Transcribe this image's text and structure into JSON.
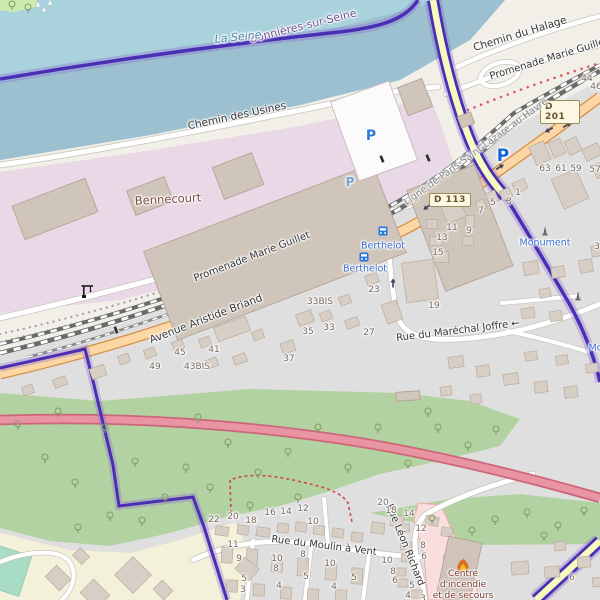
{
  "shields": {
    "d113": {
      "label": "D 113",
      "x": 450,
      "y": 200
    },
    "d201": {
      "label": "D 201",
      "x": 560,
      "y": 112
    }
  },
  "labels": {
    "roads": [
      {
        "text": "Chemin des Usines",
        "x": 237,
        "y": 116,
        "rot": -12,
        "size": 10.5
      },
      {
        "text": "Chemin du Halage",
        "x": 520,
        "y": 34,
        "rot": -17,
        "size": 10.5
      },
      {
        "text": "Promenade Marie Guillet",
        "x": 549,
        "y": 59,
        "rot": -17,
        "size": 10
      },
      {
        "text": "Promenade Marie Guillet",
        "x": 252,
        "y": 257,
        "rot": -21,
        "size": 10
      },
      {
        "text": "Avenue Aristide Briand",
        "x": 206,
        "y": 319,
        "rot": -21,
        "size": 10.5
      },
      {
        "text": "Rue du Maréchal Joffre ←",
        "x": 458,
        "y": 331,
        "rot": -7,
        "size": 10
      },
      {
        "text": "Rue du Moulin à Vent",
        "x": 324,
        "y": 546,
        "rot": 7,
        "size": 10
      },
      {
        "text": "Rue Léon Richard",
        "x": 405,
        "y": 545,
        "rot": 68,
        "size": 10
      }
    ],
    "railway": [
      {
        "text": "Ligne de Paris-Saint-Lazare au Havre",
        "x": 476,
        "y": 152,
        "rot": -36,
        "size": 9.5
      }
    ],
    "places": [
      {
        "text": "Bennecourt",
        "x": 168,
        "y": 199,
        "rot": -3,
        "size": 11.5,
        "color": "#7a4b45"
      },
      {
        "text": "Bonnières-sur-Seine",
        "x": 303,
        "y": 26,
        "rot": -14,
        "size": 11,
        "color": "#6d5490"
      },
      {
        "text": "La Seine",
        "x": 238,
        "y": 37,
        "rot": -6,
        "size": 11,
        "color": "#4d7fa8",
        "italic": true
      }
    ],
    "pois": [
      {
        "text": "Berthelot",
        "x": 383,
        "y": 246,
        "size": 9.5
      },
      {
        "text": "Berthelot",
        "x": 365,
        "y": 269,
        "size": 9.5
      },
      {
        "text": "Monument",
        "x": 545,
        "y": 243,
        "size": 9.5
      },
      {
        "text": "Monument",
        "x": 614,
        "y": 348,
        "size": 9.5
      }
    ],
    "fire_station": [
      {
        "text": "Centre",
        "x": 463,
        "y": 574,
        "size": 9
      },
      {
        "text": "d'incendie",
        "x": 463,
        "y": 585,
        "size": 9
      },
      {
        "text": "et de secours",
        "x": 463,
        "y": 596,
        "size": 9
      }
    ],
    "parkings": [
      {
        "text": "P",
        "x": 371,
        "y": 136,
        "size": 14,
        "color": "#2e7cd6",
        "op": 1
      },
      {
        "text": "P",
        "x": 350,
        "y": 182,
        "size": 12,
        "color": "#5f9bd8",
        "op": 0.8
      },
      {
        "text": "P",
        "x": 503,
        "y": 156,
        "size": 17,
        "color": "#1565d8",
        "op": 1
      }
    ],
    "housenumbers": [
      {
        "text": "44",
        "x": 587,
        "y": 79
      },
      {
        "text": "46",
        "x": 596,
        "y": 87
      },
      {
        "text": "63",
        "x": 545,
        "y": 169
      },
      {
        "text": "61",
        "x": 561,
        "y": 169
      },
      {
        "text": "59",
        "x": 576,
        "y": 169
      },
      {
        "text": "57",
        "x": 595,
        "y": 170
      },
      {
        "text": "1",
        "x": 518,
        "y": 193
      },
      {
        "text": "3",
        "x": 509,
        "y": 202
      },
      {
        "text": "5",
        "x": 493,
        "y": 203
      },
      {
        "text": "7",
        "x": 481,
        "y": 211
      },
      {
        "text": "11",
        "x": 452,
        "y": 228
      },
      {
        "text": "9",
        "x": 469,
        "y": 231
      },
      {
        "text": "13",
        "x": 442,
        "y": 238
      },
      {
        "text": "15",
        "x": 438,
        "y": 253
      },
      {
        "text": "19",
        "x": 434,
        "y": 306
      },
      {
        "text": "3",
        "x": 597,
        "y": 247
      },
      {
        "text": "23",
        "x": 374,
        "y": 290
      },
      {
        "text": "33BIS",
        "x": 320,
        "y": 302
      },
      {
        "text": "33",
        "x": 329,
        "y": 328
      },
      {
        "text": "35",
        "x": 308,
        "y": 332
      },
      {
        "text": "27",
        "x": 369,
        "y": 333
      },
      {
        "text": "37",
        "x": 289,
        "y": 359
      },
      {
        "text": "41",
        "x": 214,
        "y": 350
      },
      {
        "text": "45",
        "x": 180,
        "y": 353
      },
      {
        "text": "43BIS",
        "x": 197,
        "y": 367
      },
      {
        "text": "49",
        "x": 155,
        "y": 367
      },
      {
        "text": "22",
        "x": 214,
        "y": 520
      },
      {
        "text": "20",
        "x": 233,
        "y": 517
      },
      {
        "text": "18",
        "x": 251,
        "y": 521
      },
      {
        "text": "16",
        "x": 270,
        "y": 513
      },
      {
        "text": "14",
        "x": 286,
        "y": 512
      },
      {
        "text": "12",
        "x": 303,
        "y": 509
      },
      {
        "text": "10",
        "x": 313,
        "y": 522
      },
      {
        "text": "11",
        "x": 233,
        "y": 545
      },
      {
        "text": "9",
        "x": 239,
        "y": 559
      },
      {
        "text": "5",
        "x": 244,
        "y": 579
      },
      {
        "text": "3",
        "x": 243,
        "y": 590
      },
      {
        "text": "10",
        "x": 277,
        "y": 559
      },
      {
        "text": "8",
        "x": 276,
        "y": 569
      },
      {
        "text": "8",
        "x": 303,
        "y": 555
      },
      {
        "text": "5",
        "x": 306,
        "y": 577
      },
      {
        "text": "4",
        "x": 279,
        "y": 586
      },
      {
        "text": "10",
        "x": 330,
        "y": 564
      },
      {
        "text": "5",
        "x": 354,
        "y": 578
      },
      {
        "text": "4",
        "x": 334,
        "y": 587
      },
      {
        "text": "20",
        "x": 383,
        "y": 503
      },
      {
        "text": "18",
        "x": 391,
        "y": 511
      },
      {
        "text": "14",
        "x": 409,
        "y": 514
      },
      {
        "text": "12",
        "x": 421,
        "y": 529
      },
      {
        "text": "8",
        "x": 423,
        "y": 546
      },
      {
        "text": "6",
        "x": 424,
        "y": 557
      },
      {
        "text": "10",
        "x": 387,
        "y": 561
      },
      {
        "text": "8",
        "x": 393,
        "y": 572
      },
      {
        "text": "6",
        "x": 395,
        "y": 581
      },
      {
        "text": "5",
        "x": 412,
        "y": 586
      },
      {
        "text": "4",
        "x": 408,
        "y": 596
      },
      {
        "text": "3",
        "x": 423,
        "y": 599
      },
      {
        "text": "6",
        "x": 572,
        "y": 578
      }
    ]
  },
  "icons": [
    {
      "type": "bus",
      "x": 383,
      "y": 231
    },
    {
      "type": "bus",
      "x": 364,
      "y": 257
    },
    {
      "type": "monument",
      "x": 545,
      "y": 231
    },
    {
      "type": "monument",
      "x": 578,
      "y": 296
    },
    {
      "type": "crane",
      "x": 87,
      "y": 291
    },
    {
      "type": "flame",
      "x": 463,
      "y": 566
    },
    {
      "type": "boat",
      "x": 38,
      "y": 5
    },
    {
      "type": "boat",
      "x": 50,
      "y": 3
    },
    {
      "type": "boat",
      "x": 44,
      "y": 10
    },
    {
      "type": "crossing",
      "x": 382,
      "y": 159,
      "rot": -22
    },
    {
      "type": "crossing",
      "x": 428,
      "y": 158,
      "rot": -22
    },
    {
      "type": "crossing",
      "x": 116,
      "y": 330,
      "rot": -20
    }
  ],
  "arrows": [
    {
      "x": 427,
      "y": 207,
      "rot": 142
    },
    {
      "x": 500,
      "y": 167,
      "rot": -33
    },
    {
      "x": 549,
      "y": 130,
      "rot": 150
    },
    {
      "x": 567,
      "y": 125,
      "rot": -30
    },
    {
      "x": 393,
      "y": 283,
      "rot": -90
    }
  ],
  "colors": {
    "water": "#a9d2dd",
    "water_south": "#9cc0cf",
    "boundary": "#4a2fb5",
    "primary_road": "#fcd6a4",
    "trunk_road": "#e894a2",
    "secondary_road": "#f7fabf",
    "industrial": "#e9d8e5",
    "green": "#b3d2a2",
    "farmland": "#f4f1da",
    "poi_blue": "#3b6ed0",
    "fire_label": "#7a3a28",
    "fire_area": "#fadddd"
  },
  "map_geometry": {
    "industrial_buildings": [
      [
        275,
        252,
        245,
        95,
        -21
      ],
      [
        460,
        228,
        72,
        108,
        -21
      ],
      [
        55,
        209,
        78,
        36,
        -21
      ],
      [
        238,
        176,
        42,
        34,
        -21
      ],
      [
        150,
        196,
        40,
        26,
        -21
      ],
      [
        415,
        97,
        26,
        30,
        -21
      ],
      [
        466,
        120,
        14,
        12,
        -21
      ],
      [
        408,
        396,
        24,
        9,
        -4
      ]
    ],
    "parking_structure": [
      374,
      131,
      62,
      84,
      -20
    ],
    "fire_building": [
      459,
      570,
      34,
      62,
      12
    ],
    "residential_buildings": [
      [
        540,
        153,
        16,
        20,
        -24
      ],
      [
        557,
        148,
        13,
        16,
        -24
      ],
      [
        573,
        146,
        13,
        15,
        -24
      ],
      [
        592,
        152,
        17,
        13,
        -24
      ],
      [
        570,
        189,
        27,
        32,
        -24
      ],
      [
        600,
        170,
        12,
        14,
        -24
      ],
      [
        520,
        186,
        13,
        11,
        -24
      ],
      [
        506,
        194,
        11,
        10,
        -24
      ],
      [
        492,
        197,
        10,
        11,
        -24
      ],
      [
        481,
        205,
        9,
        10,
        -24
      ],
      [
        452,
        208,
        20,
        26,
        -24
      ],
      [
        432,
        224,
        11,
        9,
        0
      ],
      [
        436,
        241,
        13,
        9,
        0
      ],
      [
        441,
        257,
        15,
        11,
        0
      ],
      [
        470,
        221,
        9,
        11,
        0
      ],
      [
        468,
        241,
        11,
        9,
        0
      ],
      [
        420,
        281,
        32,
        40,
        -8
      ],
      [
        392,
        312,
        16,
        20,
        -20
      ],
      [
        531,
        268,
        15,
        13,
        -10
      ],
      [
        558,
        272,
        13,
        11,
        -10
      ],
      [
        586,
        266,
        13,
        13,
        -10
      ],
      [
        545,
        293,
        11,
        9,
        -10
      ],
      [
        596,
        251,
        9,
        11,
        -10
      ],
      [
        528,
        313,
        13,
        10,
        -8
      ],
      [
        556,
        316,
        12,
        10,
        -8
      ],
      [
        456,
        362,
        15,
        11,
        -8
      ],
      [
        483,
        371,
        13,
        11,
        -8
      ],
      [
        511,
        379,
        15,
        11,
        -8
      ],
      [
        541,
        387,
        13,
        11,
        -8
      ],
      [
        571,
        392,
        13,
        11,
        -8
      ],
      [
        446,
        391,
        11,
        9,
        -8
      ],
      [
        476,
        399,
        11,
        9,
        -8
      ],
      [
        531,
        356,
        12,
        9,
        -8
      ],
      [
        562,
        360,
        12,
        9,
        -8
      ],
      [
        592,
        368,
        12,
        9,
        -8
      ],
      [
        372,
        279,
        12,
        10,
        -20
      ],
      [
        345,
        300,
        11,
        9,
        -20
      ],
      [
        305,
        318,
        16,
        12,
        -20
      ],
      [
        326,
        316,
        11,
        9,
        -20
      ],
      [
        352,
        323,
        13,
        9,
        -20
      ],
      [
        232,
        329,
        34,
        15,
        -20
      ],
      [
        288,
        347,
        13,
        11,
        -20
      ],
      [
        258,
        335,
        11,
        9,
        -20
      ],
      [
        205,
        342,
        11,
        9,
        -20
      ],
      [
        178,
        345,
        11,
        9,
        -20
      ],
      [
        150,
        353,
        11,
        9,
        -20
      ],
      [
        124,
        359,
        11,
        9,
        -20
      ],
      [
        240,
        359,
        13,
        9,
        -20
      ],
      [
        212,
        363,
        11,
        9,
        -20
      ],
      [
        98,
        372,
        15,
        11,
        -20
      ],
      [
        60,
        382,
        13,
        9,
        -20
      ],
      [
        28,
        390,
        11,
        9,
        -20
      ],
      [
        222,
        531,
        13,
        9,
        8
      ],
      [
        243,
        530,
        11,
        9,
        8
      ],
      [
        263,
        532,
        13,
        9,
        8
      ],
      [
        283,
        528,
        11,
        9,
        8
      ],
      [
        301,
        527,
        11,
        9,
        8
      ],
      [
        319,
        530,
        11,
        9,
        8
      ],
      [
        338,
        533,
        11,
        9,
        8
      ],
      [
        357,
        537,
        11,
        9,
        8
      ],
      [
        378,
        528,
        13,
        11,
        8
      ],
      [
        397,
        521,
        13,
        11,
        8
      ],
      [
        227,
        555,
        11,
        16,
        3
      ],
      [
        252,
        558,
        11,
        18,
        3
      ],
      [
        277,
        564,
        11,
        16,
        3
      ],
      [
        303,
        567,
        11,
        18,
        3
      ],
      [
        331,
        572,
        11,
        16,
        3
      ],
      [
        357,
        576,
        11,
        16,
        3
      ],
      [
        232,
        586,
        11,
        12,
        3
      ],
      [
        259,
        590,
        11,
        12,
        3
      ],
      [
        286,
        593,
        11,
        12,
        3
      ],
      [
        313,
        595,
        11,
        12,
        3
      ],
      [
        341,
        596,
        11,
        12,
        3
      ],
      [
        404,
        528,
        11,
        8,
        0
      ],
      [
        406,
        546,
        11,
        8,
        0
      ],
      [
        407,
        558,
        11,
        8,
        0
      ],
      [
        401,
        572,
        10,
        8,
        0
      ],
      [
        403,
        583,
        10,
        8,
        0
      ],
      [
        417,
        594,
        11,
        8,
        0
      ],
      [
        432,
        521,
        13,
        9,
        10
      ],
      [
        447,
        532,
        11,
        9,
        10
      ],
      [
        449,
        560,
        11,
        9,
        0
      ],
      [
        452,
        585,
        13,
        11,
        0
      ],
      [
        520,
        568,
        17,
        13,
        -5
      ],
      [
        552,
        572,
        15,
        11,
        -5
      ],
      [
        584,
        562,
        13,
        11,
        -5
      ],
      [
        560,
        546,
        11,
        9,
        -5
      ],
      [
        598,
        582,
        11,
        9,
        -5
      ],
      [
        58,
        578,
        20,
        16,
        45
      ],
      [
        95,
        594,
        23,
        19,
        45
      ],
      [
        133,
        575,
        26,
        26,
        45
      ],
      [
        163,
        590,
        15,
        13,
        45
      ],
      [
        247,
        569,
        19,
        15,
        40
      ],
      [
        81,
        556,
        13,
        11,
        45
      ]
    ],
    "trees_main": [
      [
        18,
        425
      ],
      [
        45,
        458
      ],
      [
        75,
        483
      ],
      [
        105,
        428
      ],
      [
        135,
        462
      ],
      [
        165,
        498
      ],
      [
        110,
        516
      ],
      [
        198,
        418
      ],
      [
        186,
        468
      ],
      [
        228,
        443
      ],
      [
        258,
        473
      ],
      [
        288,
        452
      ],
      [
        318,
        428
      ],
      [
        348,
        468
      ],
      [
        298,
        498
      ],
      [
        378,
        428
      ],
      [
        408,
        464
      ],
      [
        438,
        428
      ],
      [
        468,
        446
      ],
      [
        428,
        412
      ],
      [
        496,
        430
      ],
      [
        142,
        521
      ],
      [
        78,
        528
      ],
      [
        250,
        506
      ],
      [
        58,
        412
      ],
      [
        210,
        488
      ]
    ],
    "trees_strip": [
      [
        432,
        519
      ],
      [
        472,
        531
      ],
      [
        495,
        520
      ],
      [
        527,
        513
      ],
      [
        544,
        536
      ],
      [
        558,
        526
      ],
      [
        584,
        511
      ]
    ],
    "trees_corner": [
      [
        12,
        5
      ],
      [
        28,
        8
      ]
    ]
  }
}
